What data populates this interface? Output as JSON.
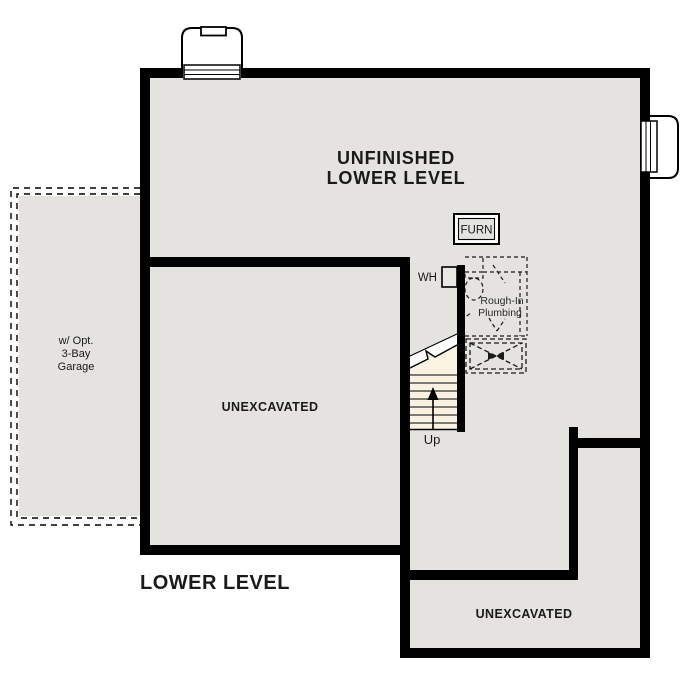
{
  "title": "LOWER LEVEL",
  "labels": {
    "main_room": {
      "line1": "UNFINISHED",
      "line2": "LOWER LEVEL"
    },
    "middle_room": "UNEXCAVATED",
    "bottom_room": "UNEXCAVATED",
    "garage": {
      "line1": "w/ Opt.",
      "line2": "3-Bay",
      "line3": "Garage"
    },
    "furnace": "FURN",
    "water_heater": "WH",
    "plumbing": {
      "line1": "Rough-In",
      "line2": "Plumbing"
    },
    "stairs": "Up"
  },
  "colors": {
    "wall": "#000000",
    "interior": "#e4e3e0",
    "stairs": "#faf3e2",
    "dashes": "#1a1a1a",
    "background": "#ffffff"
  }
}
